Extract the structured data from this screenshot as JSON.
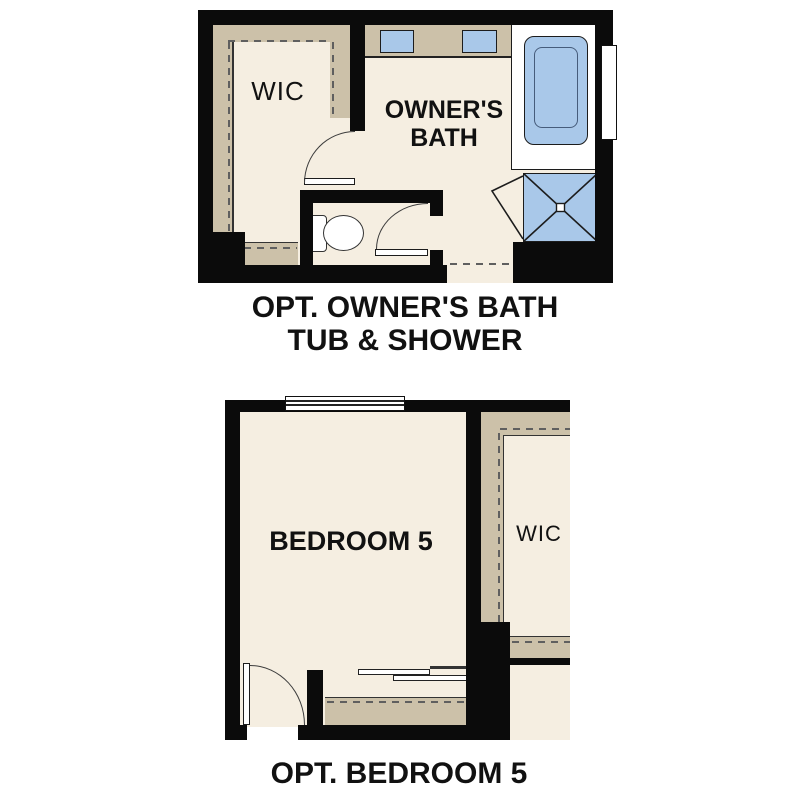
{
  "colors": {
    "background": "#ffffff",
    "wall": "#0b0b0b",
    "floor": "#f5eee1",
    "shelf": "#ccc1a9",
    "fixture": "#a9c8e9",
    "line": "#333333",
    "dash": "#5f5f5f",
    "text": "#111111"
  },
  "owners_bath_plan": {
    "wic_label": "WIC",
    "bath_label_line1": "OWNER'S",
    "bath_label_line2": "BATH",
    "caption_line1": "OPT. OWNER'S BATH",
    "caption_line2": "TUB & SHOWER"
  },
  "bedroom_plan": {
    "bedroom_label": "BEDROOM 5",
    "wic_label": "WIC",
    "caption": "OPT. BEDROOM 5"
  }
}
